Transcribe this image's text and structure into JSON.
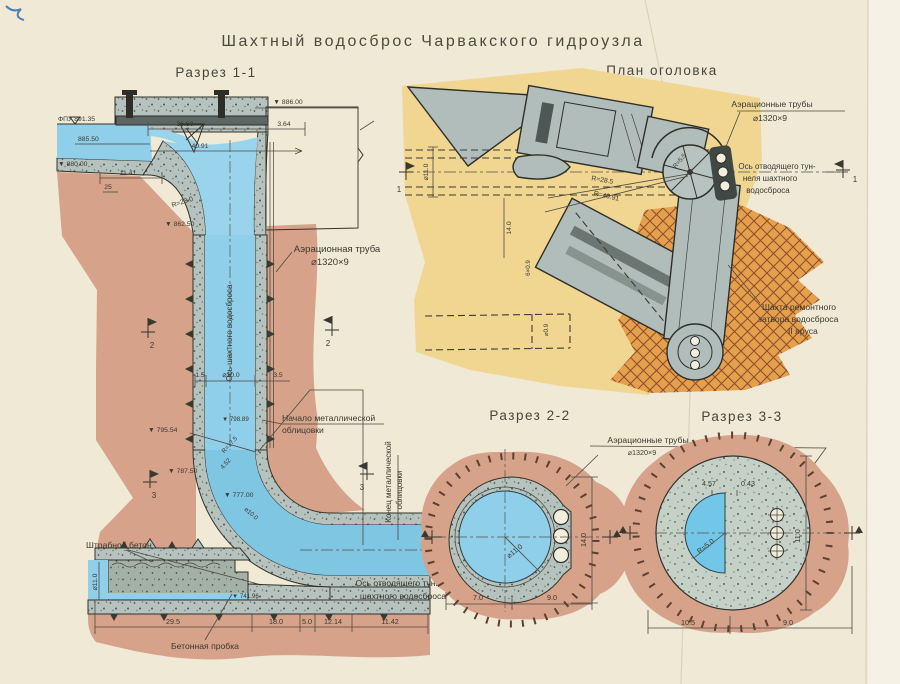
{
  "title": "Шахтный водосброс Чарвакского гидроузла",
  "colors": {
    "water": "#8fcfe9",
    "rock": "#d6a289",
    "plan_bg": "#f1d692",
    "dam": "#efac38",
    "concrete": "#b5c2bd",
    "paper": "#efe9d6",
    "line": "#33322b"
  },
  "markers": {
    "m1": "1",
    "m2": "2",
    "m3": "3"
  },
  "section11": {
    "title": "Разрез 1-1",
    "levels": {
      "fpu": "ФПУ 891.35",
      "l885": "885.50",
      "l880": "▼ 880.00",
      "l886": "▼ 886.00",
      "l862": "▼ 862.50",
      "l798": "▼ 798.89",
      "l795": "▼ 795.54",
      "l787": "▼ 787.50",
      "l777": "▼ 777.00",
      "l741": "▼ 741.96"
    },
    "dims": {
      "d3650": "36.50",
      "d364": "3.64",
      "d4091": "40.91",
      "d1141": "11.41",
      "d25": "25",
      "r23": "R=23.0",
      "d15": "1.5",
      "d100": "⌀10.0",
      "d35": "3.5",
      "r175": "R=17.5",
      "d452": "4.52",
      "d100b": "⌀10.0",
      "d110": "⌀11.0",
      "d295": "29.5",
      "d180": "18.0",
      "d50": "5.0",
      "d1214": "12.14",
      "d1142": "11.42"
    },
    "labels": {
      "shaft_axis": "Ось шахтного водосброса",
      "aeration1": "Аэрационная труба",
      "aeration2": "⌀1320×9",
      "metal_start1": "Начало металлической",
      "metal_start2": "облицовки",
      "metal_end1": "Конец металлической",
      "metal_end2": "облицовки",
      "shtrab": "Штрабной бетон",
      "plug": "Бетонная пробка",
      "outlet1": "Ось отводящего туннеля",
      "outlet2": "шахтного  водосброса"
    }
  },
  "plan": {
    "title": "План оголовка",
    "labels": {
      "aeration1": "Аэрационные трубы",
      "aeration2": "⌀1320×9",
      "outlet1": "Ось отводящего тун-",
      "outlet2": "неля шахтного",
      "outlet3": "водосброса",
      "repair1": "Шахта ремонтного",
      "repair2": "затвора водосброса",
      "repair3": "II яруса"
    },
    "dims": {
      "r285": "R=28.5",
      "r4091": "R=40.91",
      "d140": "14.0",
      "d110": "⌀11.0",
      "d09": "⌀0.9",
      "d609": "6×0.9",
      "r55": "R=5.5"
    }
  },
  "section22": {
    "title": "Разрез 2-2",
    "labels": {
      "aeration1": "Аэрационные трубы",
      "aeration2": "⌀1320×9"
    },
    "dims": {
      "d110": "⌀11.0",
      "d140": "14.0",
      "d70": "7.0",
      "d90": "9.0"
    }
  },
  "section33": {
    "title": "Разрез 3-3",
    "dims": {
      "d457": "4.57",
      "d043": "0.43",
      "r50": "R=5.0",
      "d110": "11.0",
      "d105": "10.5",
      "d90": "9.0"
    }
  }
}
